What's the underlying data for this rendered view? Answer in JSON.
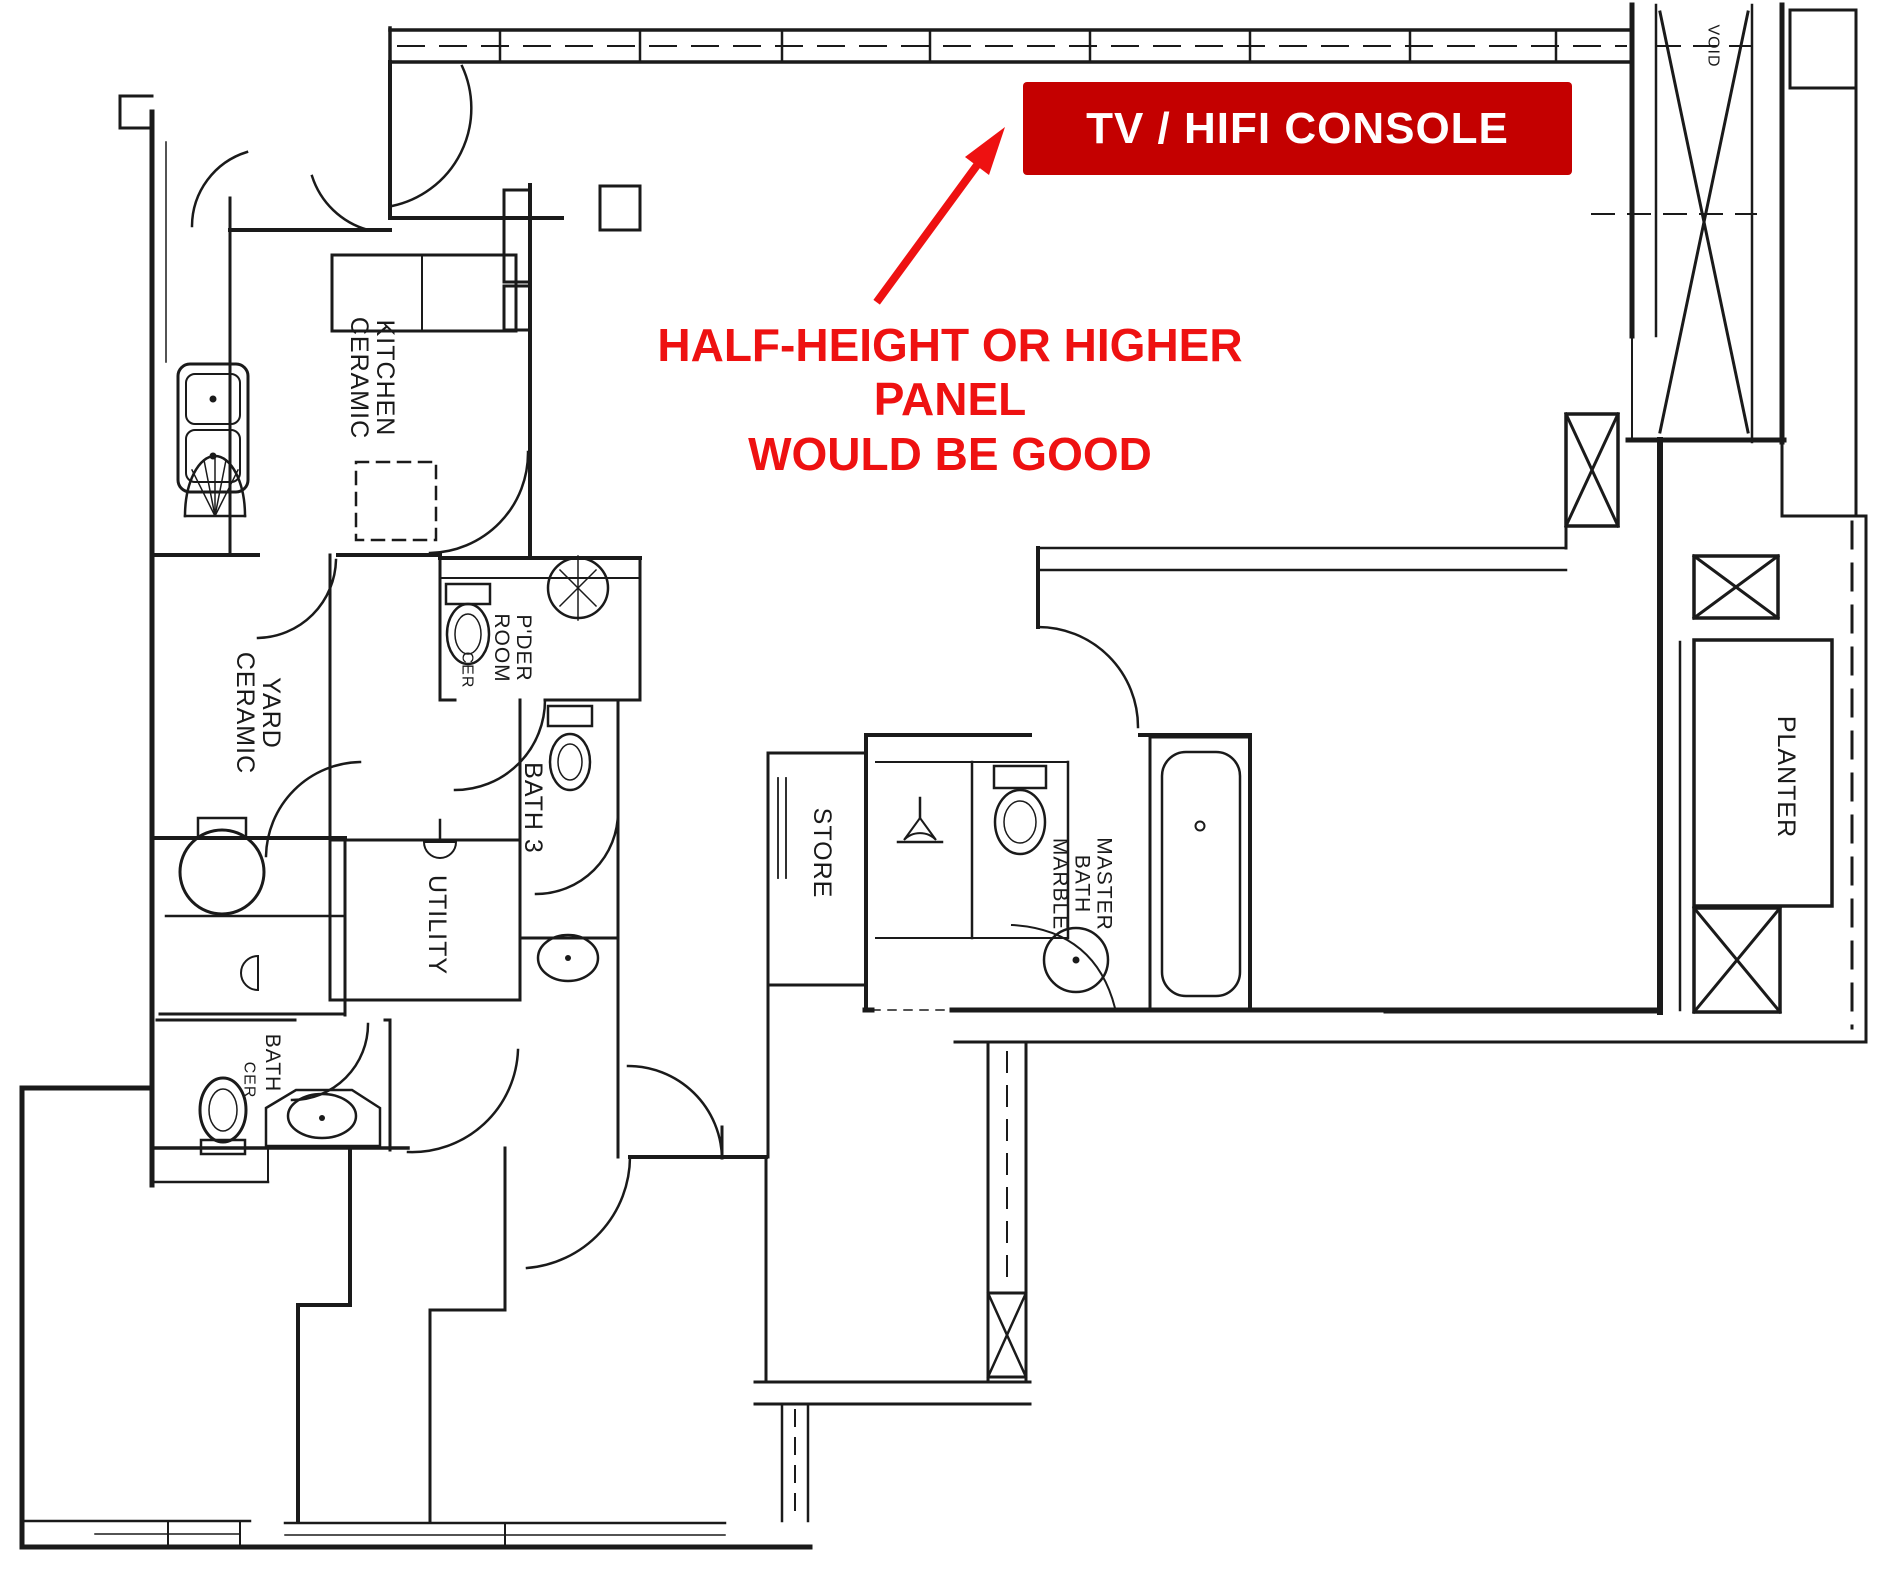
{
  "annotations": {
    "console_box": {
      "label": "TV / HIFI CONSOLE",
      "bg": "#c40000",
      "fg": "#ffffff"
    },
    "note": {
      "text": "HALF-HEIGHT OR HIGHER PANEL\nWOULD BE GOOD",
      "color": "#ee1111"
    }
  },
  "plan": {
    "line_color": "#1a1a1a",
    "labels": {
      "kitchen": "KITCHEN\nCERAMIC",
      "yard": "YARD\nCERAMIC",
      "powder_room": "P'DER\nROOM",
      "powder_room_finish": "CER",
      "bath3": "BATH 3",
      "utility": "UTILITY",
      "bath2": "BATH",
      "bath2_finish": "CER",
      "store": "STORE",
      "master_bath": "MASTER\nBATH\nMARBLE",
      "planter": "PLANTER",
      "void": "VOID"
    }
  }
}
